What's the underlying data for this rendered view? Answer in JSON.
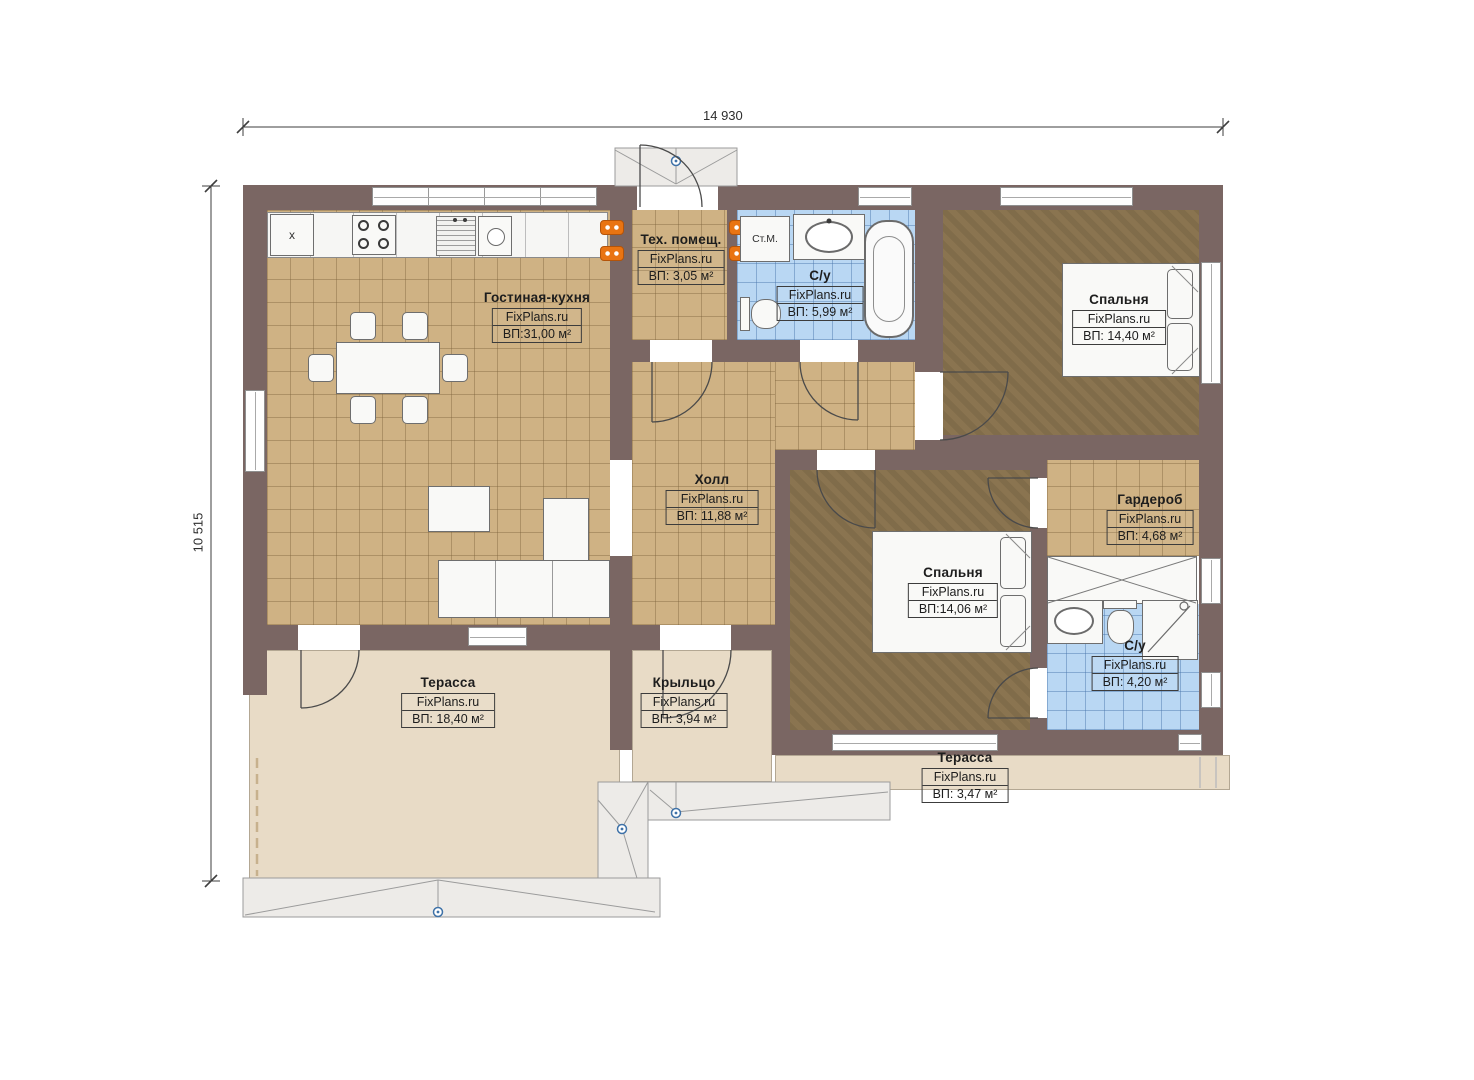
{
  "dimensions": {
    "width_label": "14 930",
    "height_label": "10 515"
  },
  "rooms": [
    {
      "name": "Гостиная-кухня",
      "brand": "FixPlans.ru",
      "area": "ВП:31,00 м²"
    },
    {
      "name": "Тех. помещ.",
      "brand": "FixPlans.ru",
      "area": "ВП: 3,05 м²"
    },
    {
      "name": "С/у",
      "brand": "FixPlans.ru",
      "area": "ВП: 5,99 м²"
    },
    {
      "name": "Спальня",
      "brand": "FixPlans.ru",
      "area": "ВП: 14,40 м²"
    },
    {
      "name": "Холл",
      "brand": "FixPlans.ru",
      "area": "ВП: 11,88 м²"
    },
    {
      "name": "Гардероб",
      "brand": "FixPlans.ru",
      "area": "ВП: 4,68 м²"
    },
    {
      "name": "Спальня",
      "brand": "FixPlans.ru",
      "area": "ВП:14,06 м²"
    },
    {
      "name": "С/у",
      "brand": "FixPlans.ru",
      "area": "ВП: 4,20 м²"
    },
    {
      "name": "Терасса",
      "brand": "FixPlans.ru",
      "area": "ВП: 18,40 м²"
    },
    {
      "name": "Крыльцо",
      "brand": "FixPlans.ru",
      "area": "ВП: 3,94 м²"
    },
    {
      "name": "Терасса",
      "brand": "FixPlans.ru",
      "area": "ВП: 3,47 м²"
    }
  ],
  "fixtures": {
    "washing_machine_label": "Ст.М.",
    "kitchen_corner_label": "x"
  },
  "colors": {
    "wall": "#7a6663",
    "tile_tan": "#cfb284",
    "tile_blue": "#b9d7f3",
    "floor_brown": "#8a7450",
    "terrace_beige": "#e8dbc6",
    "accent_orange": "#e97412",
    "canopy_gray": "#edebe8",
    "marker_blue": "#3f72a8"
  }
}
